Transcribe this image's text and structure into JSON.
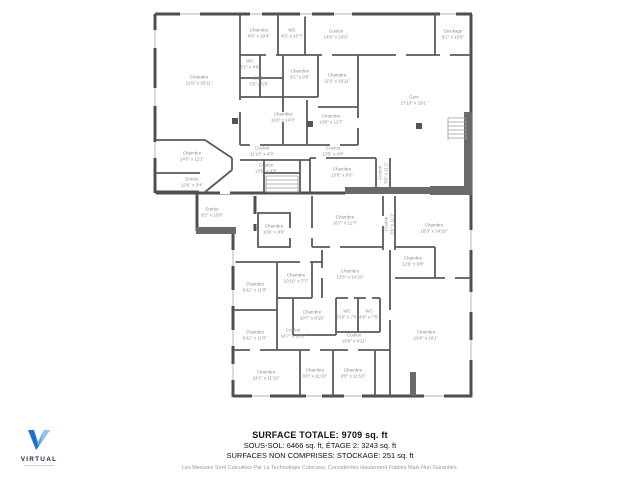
{
  "summary": {
    "line1": "SURFACE TOTALE: 9709 sq. ft",
    "line2": "SOUS-SOL: 6466 sq. ft, ÉTAGE 2: 3243 sq. ft",
    "line3": "SURFACES NON COMPRISES: STOCKAGE: 251 sq. ft",
    "disclaimer": "Les Mesures Sont Calculées Par La Technologie Cubicasa, Considérées Hautement Fiables Mais Non Garanties."
  },
  "logo": {
    "brand": "VIRTUAL",
    "icon": "v-logo-icon",
    "color_dark": "#1b2a4a",
    "color_blue": "#1f6fd6",
    "color_light_blue": "#55a8e8"
  },
  "floorplan": {
    "wall_color": "#4f4f4f",
    "label_color": "#8d8d8d",
    "rooms": [
      {
        "name": "Chambre",
        "dims": "9'6\" x 10'4\"",
        "x": 259,
        "y": 33
      },
      {
        "name": "WC",
        "dims": "4'5\" x 10'7\"",
        "x": 292,
        "y": 33
      },
      {
        "name": "Couloir",
        "dims": "14'6\" x 10'6\"",
        "x": 336,
        "y": 34
      },
      {
        "name": "Stockage",
        "dims": "9'1\" x 10'9\"",
        "x": 453,
        "y": 34
      },
      {
        "name": "Chambre",
        "dims": "21'6\" x 20'11\"",
        "x": 199,
        "y": 80
      },
      {
        "name": "WC",
        "dims": "3'1\" x 4'9\"",
        "x": 250,
        "y": 64
      },
      {
        "name": "SDB",
        "dims": "7'6\" x 5'5\"",
        "x": 259,
        "y": 81
      },
      {
        "name": "Chambre",
        "dims": "9'1\" x 9'5\"",
        "x": 300,
        "y": 74
      },
      {
        "name": "Chambre",
        "dims": "11'9\" x 10'11\"",
        "x": 337,
        "y": 78
      },
      {
        "name": "Gym",
        "dims": "27'10\" x 19'1\"",
        "x": 414,
        "y": 100
      },
      {
        "name": "Chambre",
        "dims": "11'8\" x 14'3\"",
        "x": 283,
        "y": 117
      },
      {
        "name": "Chambre",
        "dims": "13'6\" x 11'7\"",
        "x": 331,
        "y": 119
      },
      {
        "name": "Couloir",
        "dims": "11'10\" x 4'9\"",
        "x": 262,
        "y": 151
      },
      {
        "name": "Couloir",
        "dims": "13'5\" x 4'9\"",
        "x": 333,
        "y": 151
      },
      {
        "name": "Chambre",
        "dims": "14'0\" x 11'1\"",
        "x": 192,
        "y": 156
      },
      {
        "name": "Entrée",
        "dims": "12'6\" x 3'4\"",
        "x": 192,
        "y": 182
      },
      {
        "name": "Couloir",
        "dims": "13'5\" x 4'9\"",
        "x": 266,
        "y": 168
      },
      {
        "name": "Chambre",
        "dims": "13'6\" x 9'5\"",
        "x": 342,
        "y": 172
      },
      {
        "name": "Couloir",
        "dims": "3'0\" x 11'1\"",
        "x": 383,
        "y": 173,
        "rot": true
      },
      {
        "name": "Entrée",
        "dims": "9'2\" x 10'9\"",
        "x": 212,
        "y": 212
      },
      {
        "name": "Chambre",
        "dims": "10'6\" x 9'6\"",
        "x": 274,
        "y": 229
      },
      {
        "name": "Chambre",
        "dims": "16'7\" x 11'7\"",
        "x": 345,
        "y": 220
      },
      {
        "name": "Couloir",
        "dims": "3'6\" x 11'1\"",
        "x": 389,
        "y": 224,
        "rot": true
      },
      {
        "name": "Chambre",
        "dims": "16'3\" x 14'10\"",
        "x": 434,
        "y": 228
      },
      {
        "name": "Chambre",
        "dims": "12'9\" x 9'8\"",
        "x": 413,
        "y": 261
      },
      {
        "name": "Chambre",
        "dims": "8'11\" x 11'8\"",
        "x": 255,
        "y": 287
      },
      {
        "name": "Chambre",
        "dims": "10'10\" x 7'7\"",
        "x": 296,
        "y": 278
      },
      {
        "name": "Chambre",
        "dims": "13'6\" x 14'10\"",
        "x": 350,
        "y": 274
      },
      {
        "name": "Chambre",
        "dims": "10'7\" x 8'10\"",
        "x": 312,
        "y": 315
      },
      {
        "name": "WC",
        "dims": "4'10\" x 7'5\"",
        "x": 347,
        "y": 314
      },
      {
        "name": "WC",
        "dims": "4'8\" x 7'5\"",
        "x": 369,
        "y": 314
      },
      {
        "name": "Chambre",
        "dims": "8'11\" x 11'9\"",
        "x": 255,
        "y": 335
      },
      {
        "name": "Couloir",
        "dims": "14'7\" x 13'0\"",
        "x": 293,
        "y": 333
      },
      {
        "name": "Couloir",
        "dims": "10'8\" x 9'11\"",
        "x": 354,
        "y": 338
      },
      {
        "name": "Chambre",
        "dims": "19'8\" x 16'1\"",
        "x": 426,
        "y": 335
      },
      {
        "name": "Chambre",
        "dims": "24'2\" x 11'10\"",
        "x": 266,
        "y": 375
      },
      {
        "name": "Chambre",
        "dims": "9'0\" x 11'10\"",
        "x": 315,
        "y": 373
      },
      {
        "name": "Chambre",
        "dims": "9'8\" x 11'10\"",
        "x": 353,
        "y": 373
      }
    ]
  }
}
